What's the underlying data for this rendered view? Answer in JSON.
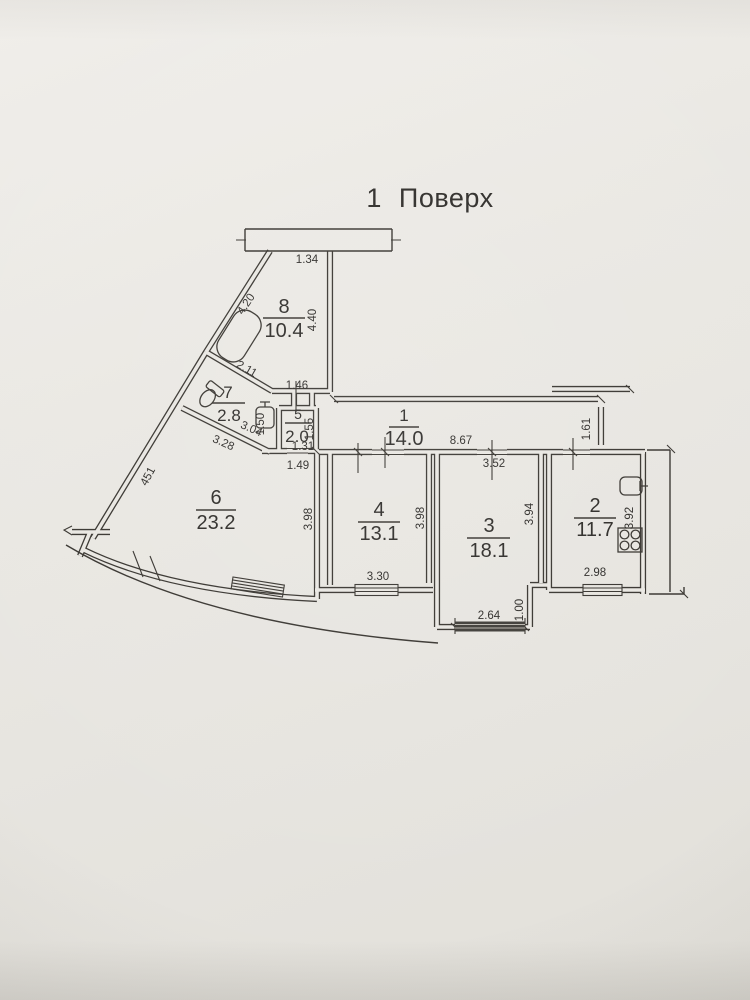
{
  "page": {
    "title": "1 Поверх"
  },
  "rooms": [
    {
      "number": "8",
      "area": "10.4"
    },
    {
      "number": "7",
      "area": "2.8"
    },
    {
      "number": "5",
      "area": "2.0"
    },
    {
      "number": "1",
      "area": "14.0"
    },
    {
      "number": "6",
      "area": "23.2"
    },
    {
      "number": "4",
      "area": "13.1"
    },
    {
      "number": "3",
      "area": "18.1"
    },
    {
      "number": "2",
      "area": "11.7"
    }
  ],
  "dimensions": {
    "balcony_top": "1.34",
    "r8_left": "4.20",
    "r8_right": "4.40",
    "r8_bottom": "2.11",
    "vestibule": "1.46",
    "r5_left": "1.50",
    "r5_right": "1.55",
    "r5_inner": "1.31",
    "r5_door": "1.49",
    "r7_wall_upper": "3.04",
    "r7_wall_lower": "3.28",
    "outer_wall": "451",
    "corridor_len": "8.67",
    "r3_top": "3.52",
    "hall_end": "1.61",
    "r6_side": "3.98",
    "r4_side": "3.98",
    "r4_window": "3.30",
    "r3_side": "3.94",
    "bay_width": "2.64",
    "bay_depth": "1.00",
    "r2_side": "3.92",
    "r2_window": "2.98"
  }
}
